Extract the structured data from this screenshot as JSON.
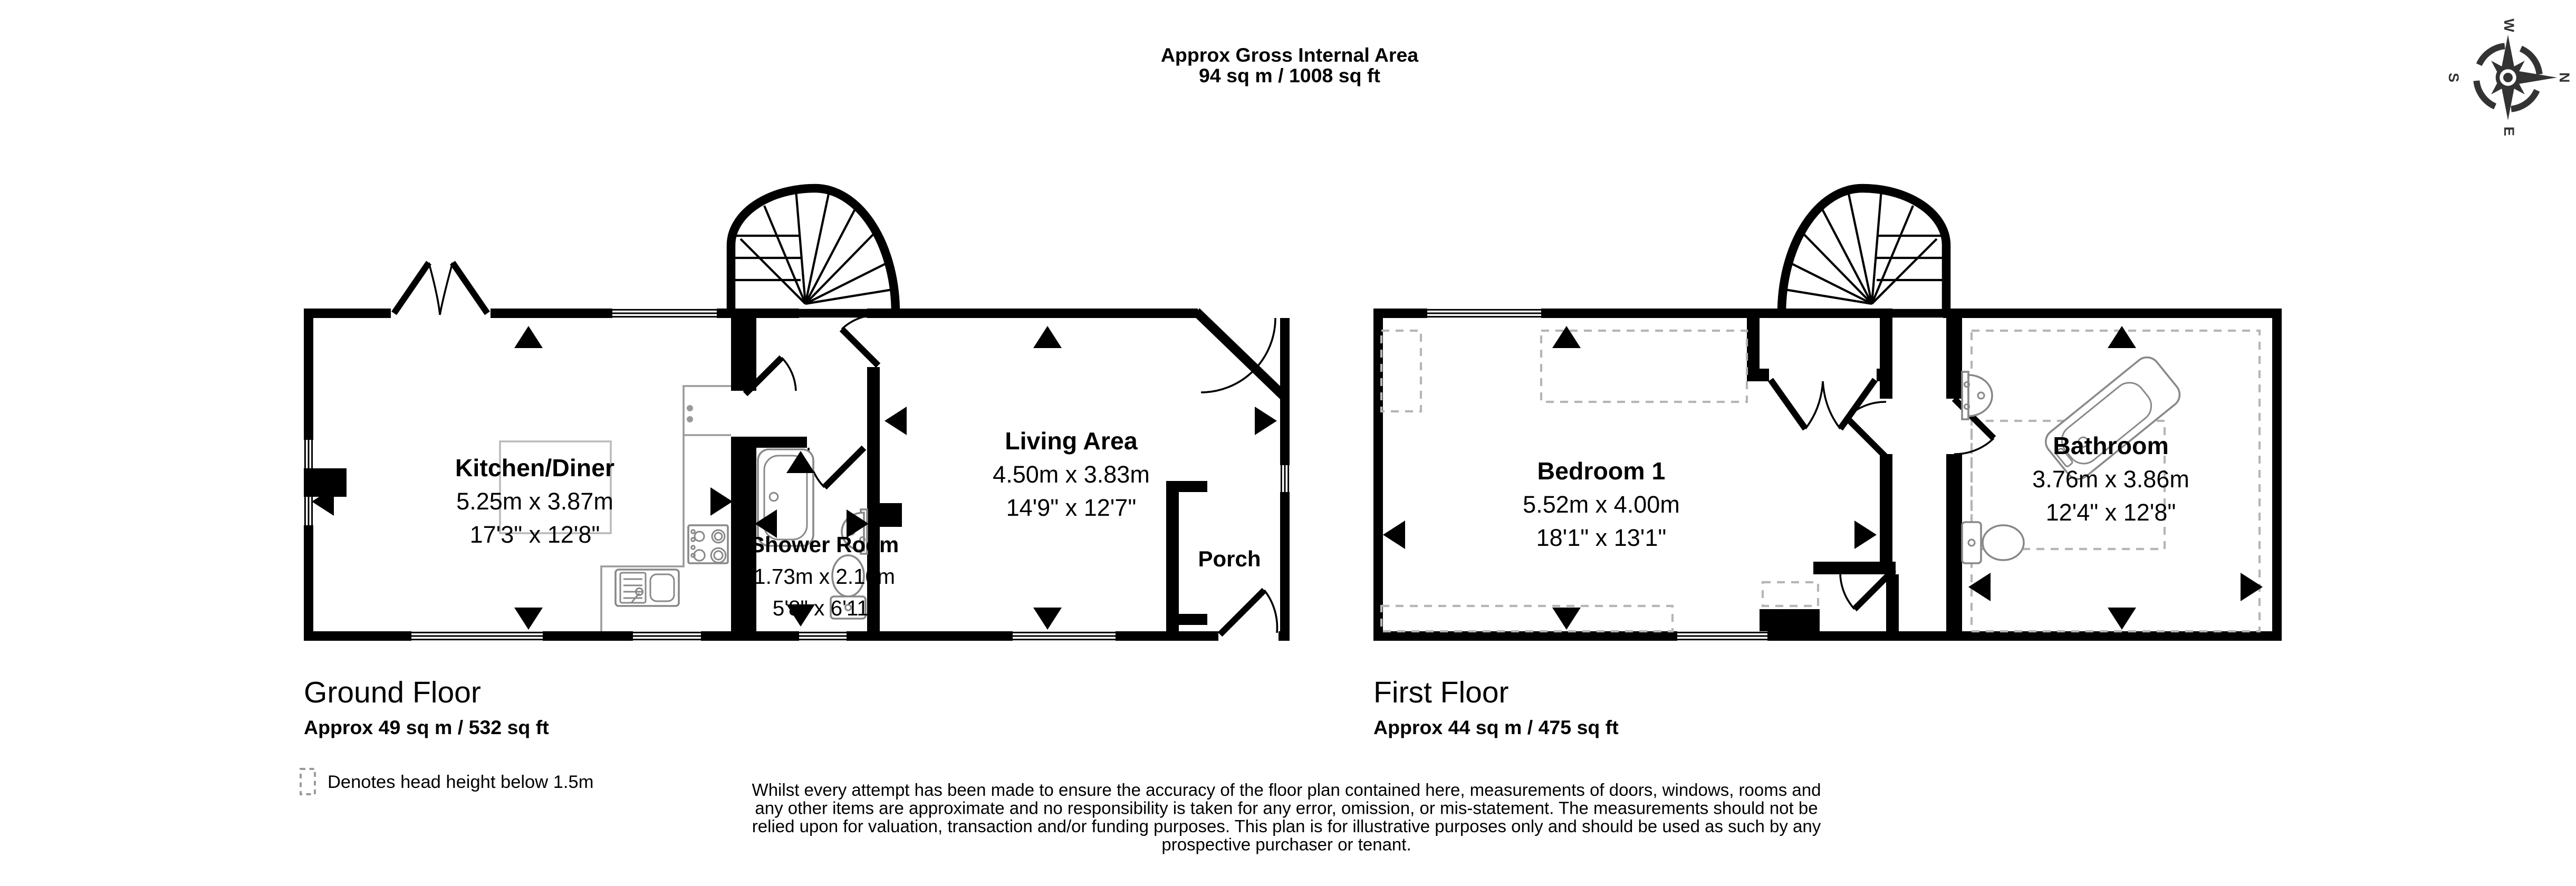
{
  "title": {
    "line1": "Approx Gross Internal Area",
    "line2": "94 sq m / 1008 sq ft"
  },
  "ground_floor": {
    "name": "Ground Floor",
    "area": "Approx 49 sq m / 532 sq ft",
    "rooms": [
      {
        "name": "Kitchen/Diner",
        "metric": "5.25m x 3.87m",
        "imperial": "17'3\" x 12'8\""
      },
      {
        "name": "Shower Room",
        "metric": "1.73m x 2.10m",
        "imperial": "5'8\" x 6'11\""
      },
      {
        "name": "Living Area",
        "metric": "4.50m x 3.83m",
        "imperial": "14'9\" x 12'7\""
      },
      {
        "name": "Porch"
      }
    ]
  },
  "first_floor": {
    "name": "First Floor",
    "area": "Approx 44 sq m / 475 sq ft",
    "rooms": [
      {
        "name": "Bedroom 1",
        "metric": "5.52m x 4.00m",
        "imperial": "18'1\" x 13'1\""
      },
      {
        "name": "Bathroom",
        "metric": "3.76m x 3.86m",
        "imperial": "12'4\" x 12'8\""
      }
    ]
  },
  "legend": {
    "label": "Denotes head height below 1.5m"
  },
  "disclaimer": {
    "line1": "Whilst every attempt has been made to ensure the accuracy of the floor plan contained here, measurements of doors, windows, rooms and",
    "line2": "any other items are approximate and no responsibility is taken for any error, omission, or mis-statement. The measurements should not be",
    "line3": "relied upon for valuation, transaction and/or funding purposes. This plan is for illustrative purposes only and should be used as such by any",
    "line4": "prospective purchaser or tenant."
  },
  "compass": {
    "n": "N",
    "e": "E",
    "s": "S",
    "w": "W"
  }
}
